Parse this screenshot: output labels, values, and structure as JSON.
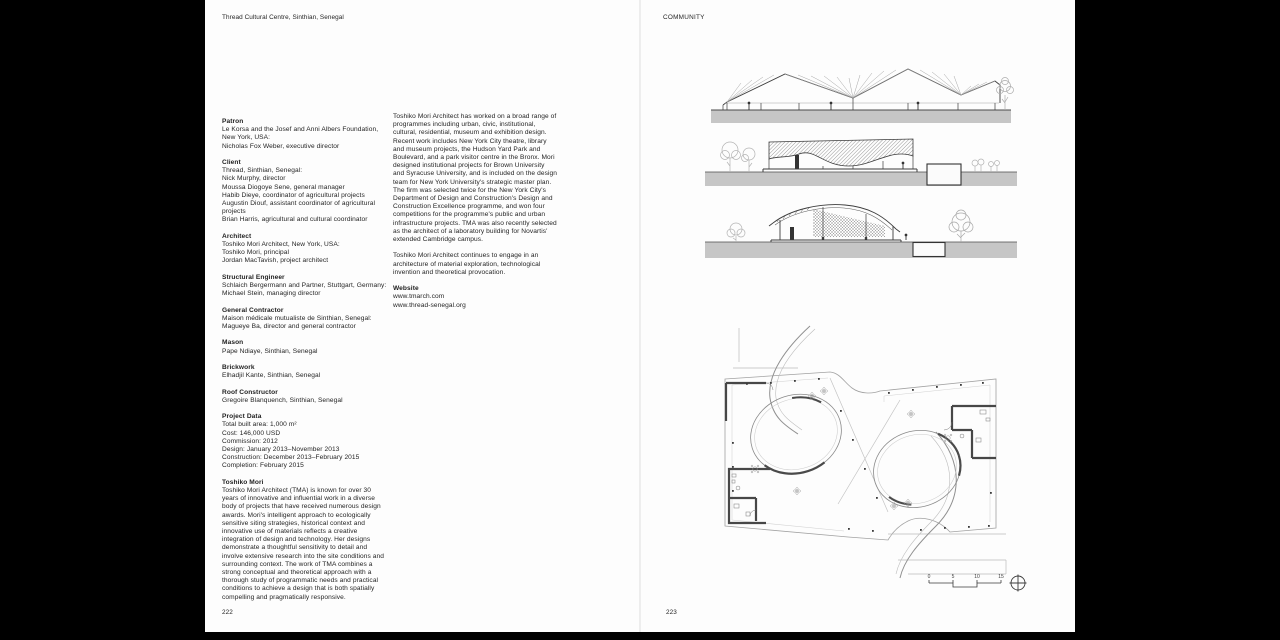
{
  "book": {
    "header_left": "Thread Cultural Centre, Sinthian, Senegal",
    "header_right": "COMMUNITY",
    "page_left": "222",
    "page_right": "223"
  },
  "credits": [
    {
      "heading": "Patron",
      "lines": [
        "Le Korsa and the Josef and Anni Albers Foundation,",
        "New York, USA:",
        "Nicholas Fox Weber, executive director"
      ]
    },
    {
      "heading": "Client",
      "lines": [
        "Thread, Sinthian, Senegal:",
        "Nick Murphy, director",
        "Moussa Diogoye Sene, general manager",
        "Habib Dieye, coordinator of agricultural projects",
        "Augustin Diouf, assistant coordinator of agricultural",
        "projects",
        "Brian Harris, agricultural and cultural coordinator"
      ]
    },
    {
      "heading": "Architect",
      "lines": [
        "Toshiko Mori Architect, New York, USA:",
        "Toshiko Mori, principal",
        "Jordan MacTavish, project architect"
      ]
    },
    {
      "heading": "Structural Engineer",
      "lines": [
        "Schlaich Bergermann and Partner, Stuttgart, Germany:",
        "Michael Stein, managing director"
      ]
    },
    {
      "heading": "General Contractor",
      "lines": [
        "Maison médicale mutualiste de Sinthian, Senegal:",
        "Magueye Ba, director and general contractor"
      ]
    },
    {
      "heading": "Mason",
      "lines": [
        "Pape Ndiaye, Sinthian, Senegal"
      ]
    },
    {
      "heading": "Brickwork",
      "lines": [
        "Elhadjil Kante, Sinthian, Senegal"
      ]
    },
    {
      "heading": "Roof Constructor",
      "lines": [
        "Gregoire Blanquench, Sinthian, Senegal"
      ]
    },
    {
      "heading": "Project Data",
      "lines": [
        "Total built area: 1,000 m²",
        "Cost: 146,000 USD",
        "Commission: 2012",
        "Design: January 2013–November 2013",
        "Construction: December 2013–February 2015",
        "Completion: February 2015"
      ]
    }
  ],
  "bio": {
    "heading": "Toshiko Mori",
    "text": "Toshiko Mori Architect (TMA) is known for over 30 years of innovative and influential work in a diverse body of projects that have received numerous design awards. Mori's intelligent approach to ecologically sensitive siting strategies, historical context and innovative use of materials reflects a creative integration of design and technology. Her designs demonstrate a thoughtful sensitivity to detail and involve extensive research into the site conditions and surrounding context. The work of TMA combines a strong conceptual and theoretical approach with a thorough study of programmatic needs and practical conditions to achieve a design that is both spatially compelling and pragmatically responsive."
  },
  "about": {
    "p1": "Toshiko Mori Architect has worked on a broad range of programmes including urban, civic, institutional, cultural, residential, museum and exhibition design. Recent work includes New York City theatre, library and museum projects, the Hudson Yard Park and Boulevard, and a park visitor centre in the Bronx. Mori designed institutional projects for Brown University and Syracuse University, and is included on the design team for New York University's strategic master plan. The firm was selected twice for the New York City's Department of Design and Construction's Design and Construction Excellence programme, and won four competitions for the programme's public and urban infrastructure projects. TMA was also recently selected as the architect of a laboratory building for Novartis' extended Cambridge campus.",
    "p2": "Toshiko Mori Architect continues to engage in an architecture of material exploration, technological invention and theoretical provocation."
  },
  "website": {
    "heading": "Website",
    "urls": [
      "www.tmarch.com",
      "www.thread-senegal.org"
    ]
  },
  "drawings": {
    "scale_bar": {
      "labels": [
        "0",
        "5",
        "10",
        "15"
      ]
    }
  }
}
